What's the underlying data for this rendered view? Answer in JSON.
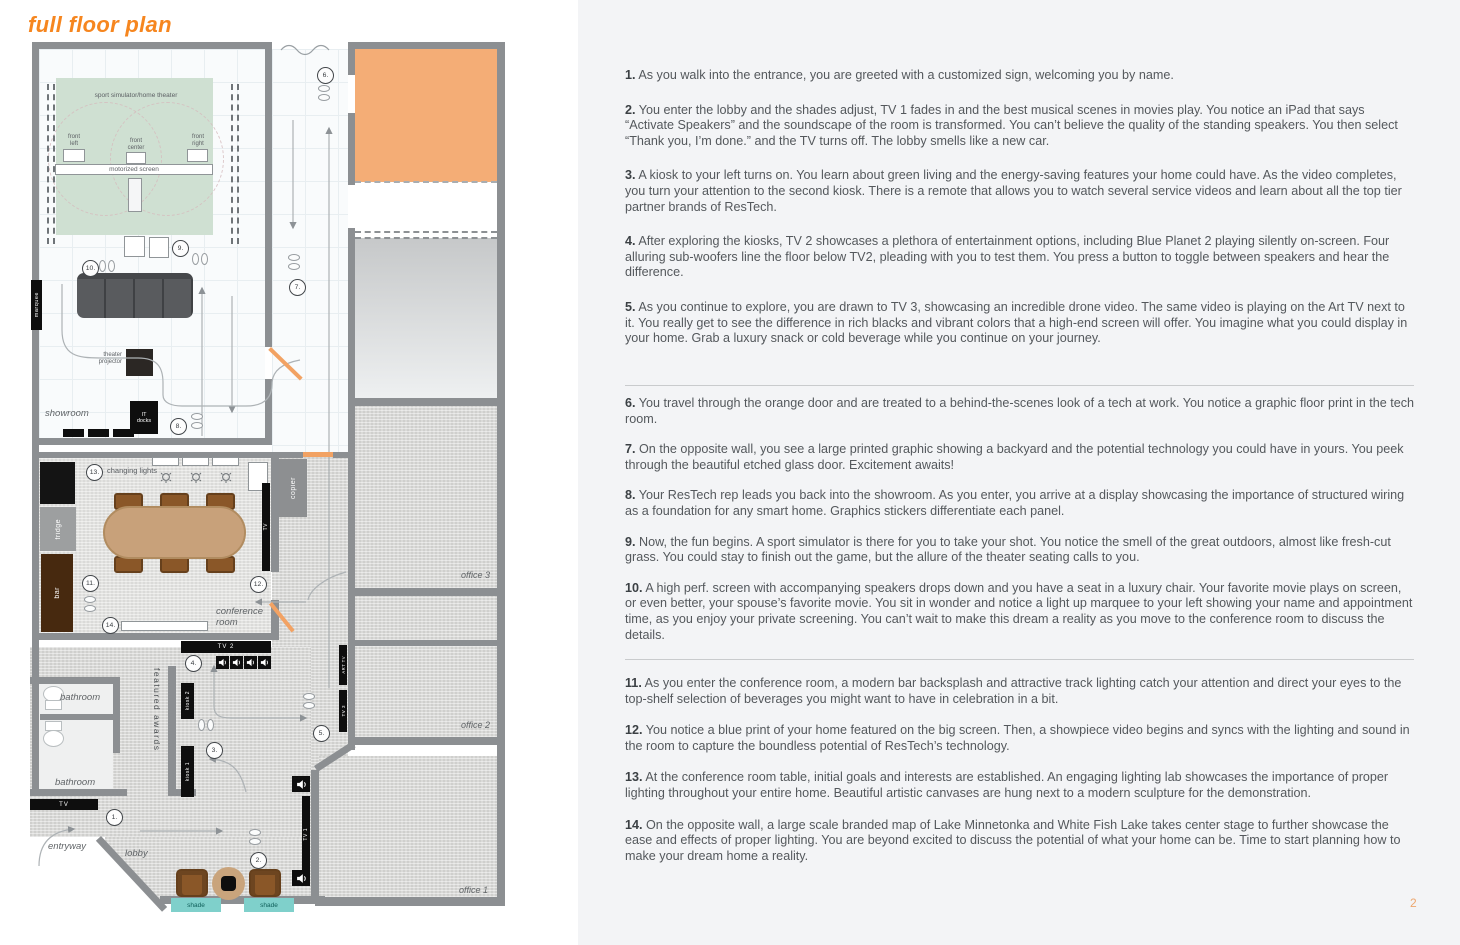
{
  "page": {
    "title": "full floor plan",
    "page_number": "2"
  },
  "colors": {
    "accent_orange": "#f6861f",
    "green_room": "#cfe0d2",
    "tech_room_orange": "#f4ad76",
    "shade_teal": "#7fd0cb",
    "wall_gray": "#8c8f92"
  },
  "floorplan": {
    "markers": [
      "1.",
      "2.",
      "3.",
      "4.",
      "5.",
      "6.",
      "7.",
      "8.",
      "9.",
      "10.",
      "11.",
      "12.",
      "13.",
      "14."
    ],
    "labels": {
      "sport_sim": "sport simulator/home theater",
      "front_left": "front\nleft",
      "front_center": "front\ncenter",
      "front_right": "front\nright",
      "motorized_screen": "motorized screen",
      "marquee": "marquee",
      "theater_projector": "theater\nprojector",
      "showroom": "showroom",
      "it_docks": "IT\ndocks",
      "changing_lights": "changing lights",
      "fridge": "fridge",
      "bar": "bar",
      "copier": "copier",
      "tv": "TV",
      "conference_room": "conference\nroom",
      "tv2": "TV 2",
      "featured_awards": "featured awards",
      "kiosk2": "kiosk 2",
      "kiosk1": "kiosk 1",
      "bathroom1": "bathroom",
      "bathroom2": "bathroom",
      "tv_entry": "TV",
      "entryway": "entryway",
      "lobby": "lobby",
      "shade1": "shade",
      "shade2": "shade",
      "tv1": "TV 1",
      "tv3": "TV 3",
      "art_tv": "ART TV",
      "office1": "office 1",
      "office2": "office 2",
      "office3": "office 3"
    }
  },
  "tour": {
    "sections": [
      {
        "items": [
          {
            "num": "1.",
            "text": "As you walk into the entrance, you are greeted with a customized sign, welcoming you by name."
          },
          {
            "num": "2.",
            "text": "You enter the lobby and the shades adjust, TV 1 fades in and the best musical scenes in movies play. You notice an iPad that says “Activate Speakers” and the soundscape of the room is transformed. You can’t believe the quality of the standing speakers. You then select “Thank you, I’m done.” and the TV turns off. The lobby smells like a new car."
          },
          {
            "num": "3.",
            "text": "A kiosk to your left turns on. You learn about green living and the energy-saving features your home could have. As the video completes, you turn your attention to the second kiosk. There is a remote that allows you to watch several service videos and learn about all the top tier partner brands of ResTech."
          },
          {
            "num": "4.",
            "text": "After exploring the kiosks, TV 2 showcases a plethora of entertainment options, including Blue Planet 2 playing silently on-screen. Four alluring sub-woofers line the floor below TV2, pleading with you to test them. You press a button to toggle between speakers and hear the difference."
          },
          {
            "num": "5.",
            "text": "As you continue to explore, you are drawn to TV 3, showcasing an incredible drone video. The same video is playing on the Art TV next to it. You really get to see the difference in rich blacks and vibrant colors that a high-end screen will offer. You imagine what you could display in your home. Grab a luxury snack or cold beverage while you continue on your journey."
          }
        ]
      },
      {
        "items": [
          {
            "num": "6.",
            "text": "You travel through the orange door and are treated to a behind-the-scenes look of a tech at work. You notice a graphic floor print in the tech room."
          },
          {
            "num": "7.",
            "text": "On the opposite wall, you see a large printed graphic showing a backyard and the potential technology you could have in yours. You peek through the beautiful etched glass door. Excitement awaits!"
          },
          {
            "num": "8.",
            "text": "Your ResTech rep leads you back into the showroom. As you enter, you arrive at a display showcasing the importance of structured wiring as a foundation for any smart home. Graphics stickers differentiate each panel."
          },
          {
            "num": "9.",
            "text": "Now, the fun begins. A sport simulator is there for you to take your shot. You notice the smell of the great outdoors, almost like fresh-cut grass. You could stay to finish out the game, but the allure of the theater seating calls to you."
          },
          {
            "num": "10.",
            "text": "A high perf. screen with accompanying speakers drops down and you have a seat in a luxury chair. Your favorite movie plays on screen, or even better, your spouse’s favorite movie. You sit in wonder and notice a light up marquee to your left showing your name and appointment time, as you enjoy your private screening. You can’t wait to make this dream a reality as you move to the conference room to discuss the details."
          }
        ]
      },
      {
        "items": [
          {
            "num": "11.",
            "text": "As you enter the conference room, a modern bar backsplash and attractive track lighting catch your attention and direct your eyes to the top-shelf selection of beverages you might want to have in celebration in a bit."
          },
          {
            "num": "12.",
            "text": "You notice a blue print of your home featured on the big screen. Then, a showpiece video begins and syncs with the lighting and sound in the room to capture the boundless potential of ResTech’s technology."
          },
          {
            "num": "13.",
            "text": "At the conference room table, initial goals and interests are established. An engaging lighting lab showcases the importance of proper lighting throughout your entire home. Beautiful artistic canvases are hung next to a modern sculpture for the demonstration."
          },
          {
            "num": "14.",
            "text": "On the opposite wall, a large scale branded map of Lake Minnetonka and White Fish Lake takes center stage to further showcase the ease and effects of proper lighting. You are beyond excited to discuss the potential of what your home can be. Time to start planning how to make your dream home a reality."
          }
        ]
      }
    ]
  }
}
